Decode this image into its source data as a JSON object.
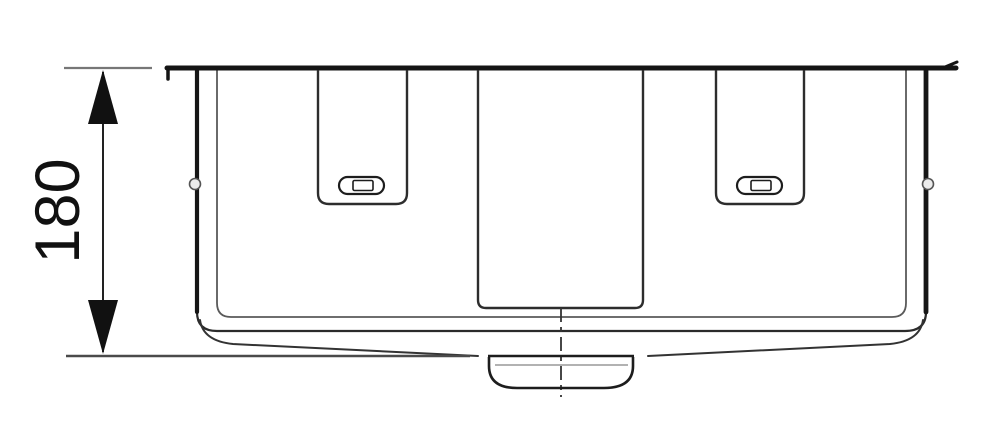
{
  "page": {
    "background_color": "#ffffff"
  },
  "drawing": {
    "kind": "technical-line-drawing",
    "view": "side-elevation",
    "line_color": "#1a1a1a",
    "thin_line_color": "#666666",
    "dimension": {
      "value": "180",
      "orientation": "vertical"
    }
  }
}
